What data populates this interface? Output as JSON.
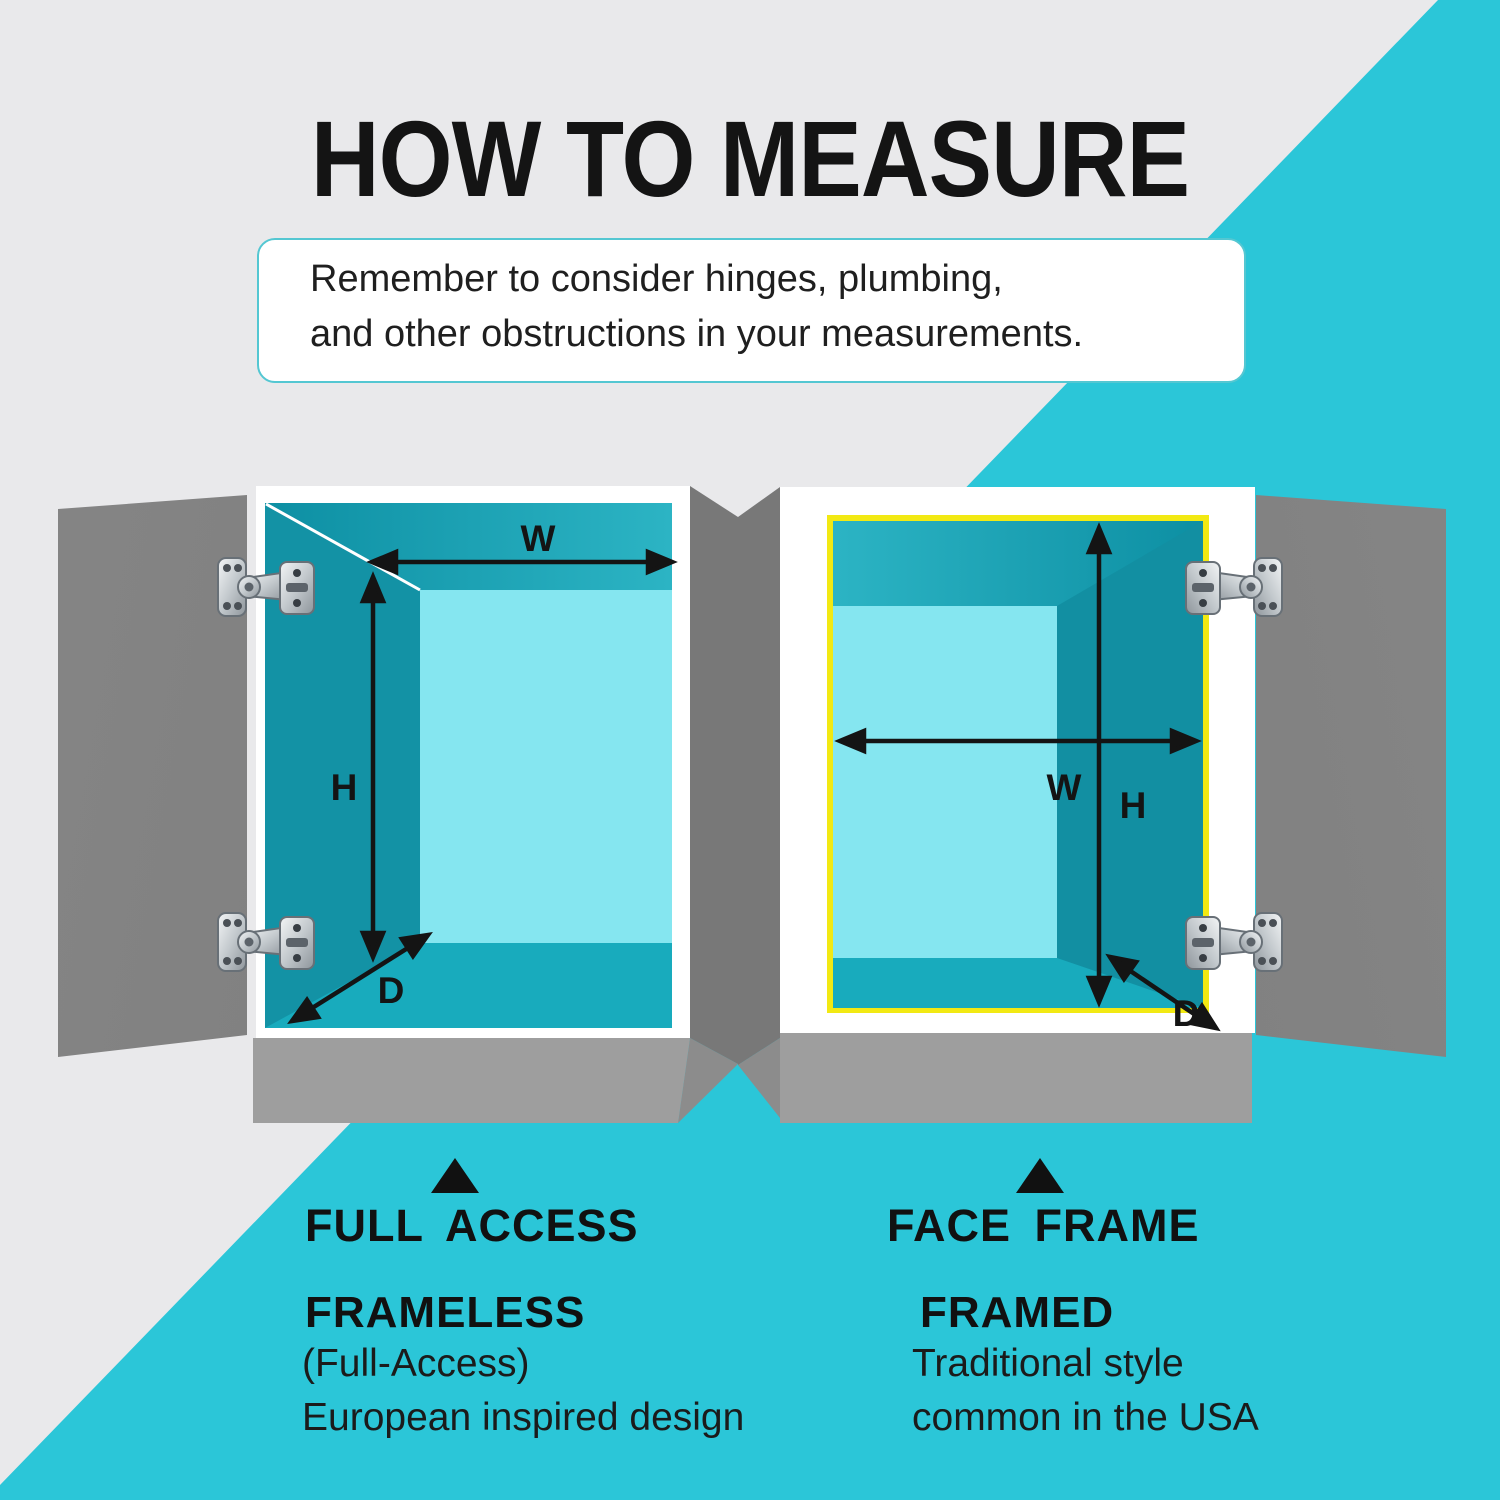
{
  "title": "HOW TO MEASURE",
  "note": {
    "line1": "Remember to consider hinges, plumbing,",
    "line2": "and other obstructions in your measurements."
  },
  "dimensions": {
    "width": "W",
    "height": "H",
    "depth": "D"
  },
  "columns": {
    "left": {
      "marker": "up-triangle",
      "heading": "FULL ACCESS",
      "subheading": "FRAMELESS",
      "body1": "(Full-Access)",
      "body2": "European inspired design"
    },
    "right": {
      "marker": "up-triangle",
      "heading": "FACE FRAME",
      "subheading": "FRAMED",
      "body1": "Traditional style",
      "body2": "common in the USA"
    }
  },
  "icons": [
    "hinge-icon",
    "width-arrow",
    "height-arrow",
    "depth-arrow",
    "up-triangle-marker"
  ],
  "colors": {
    "background_gray": "#e9e9eb",
    "accent_teal": "#2bc6d8",
    "door_gray": "#7c7c7c",
    "toekick_gray": "#9e9e9e",
    "interior_wall_teal": "#1392a5",
    "interior_back_cyan": "#85e6f0",
    "interior_bottom_teal": "#18abbd",
    "face_frame_yellow": "#f2e913",
    "note_border_teal": "#54c7d2",
    "ink": "#141414"
  }
}
